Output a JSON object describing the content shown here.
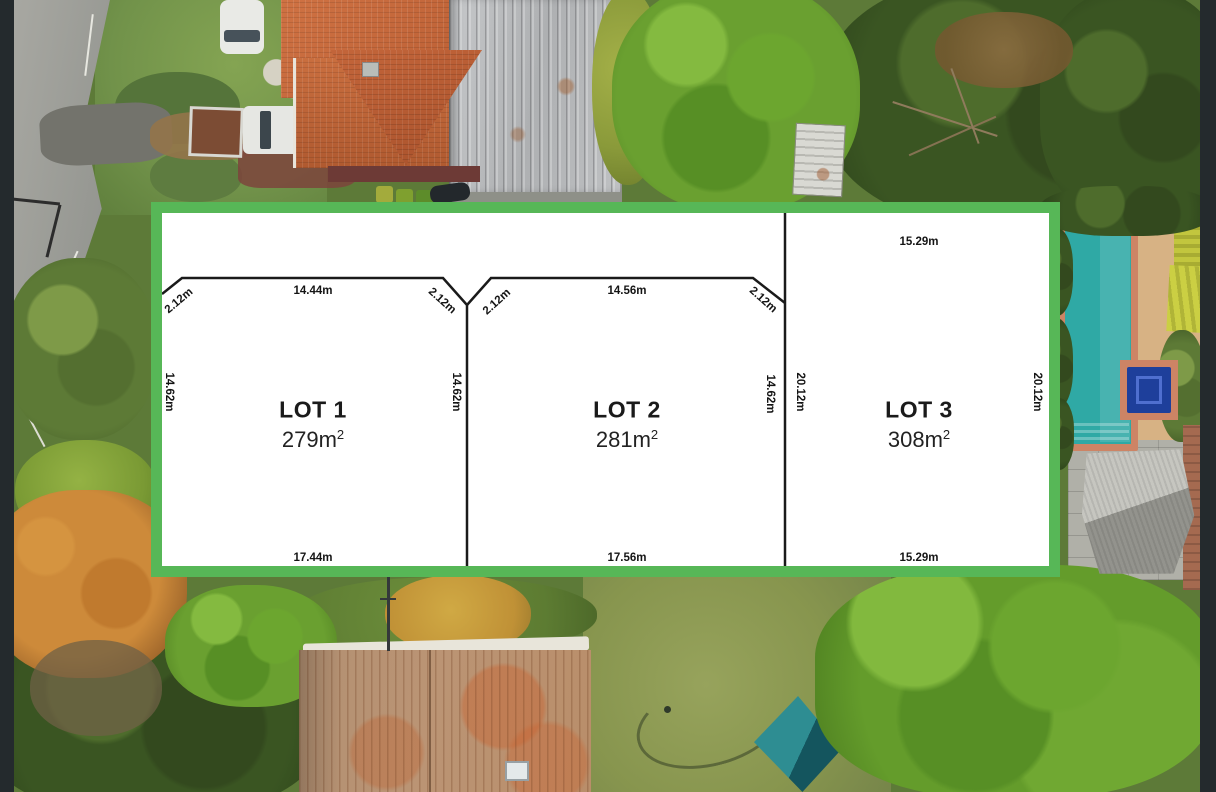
{
  "overlay": {
    "border_color": "#57b757",
    "line_color": "#1a1a1a",
    "lots": [
      {
        "name": "LOT 1",
        "area_value": "279m",
        "area_sup": "2",
        "front": "14.44m",
        "rear": "17.44m",
        "left": "14.62m",
        "right": "14.62m",
        "corner_left": "2.12m",
        "corner_right": "2.12m"
      },
      {
        "name": "LOT 2",
        "area_value": "281m",
        "area_sup": "2",
        "front": "14.56m",
        "rear": "17.56m",
        "right": "14.62m",
        "corner_left": "2.12m",
        "corner_right": "2.12m"
      },
      {
        "name": "LOT 3",
        "area_value": "308m",
        "area_sup": "2",
        "front": "15.29m",
        "rear": "15.29m",
        "left": "20.12m",
        "right": "20.12m"
      }
    ]
  },
  "photo": {
    "letterbox_color": "#242a2d",
    "pool_color": "#2fa9a5",
    "pool_coping_color": "#cd8465",
    "roof_top_house_color": "#c4683e",
    "roof_bottom_house_color": "#b5916b",
    "tent_color": "#2e8d92",
    "lawn_color": "#8c9853"
  }
}
